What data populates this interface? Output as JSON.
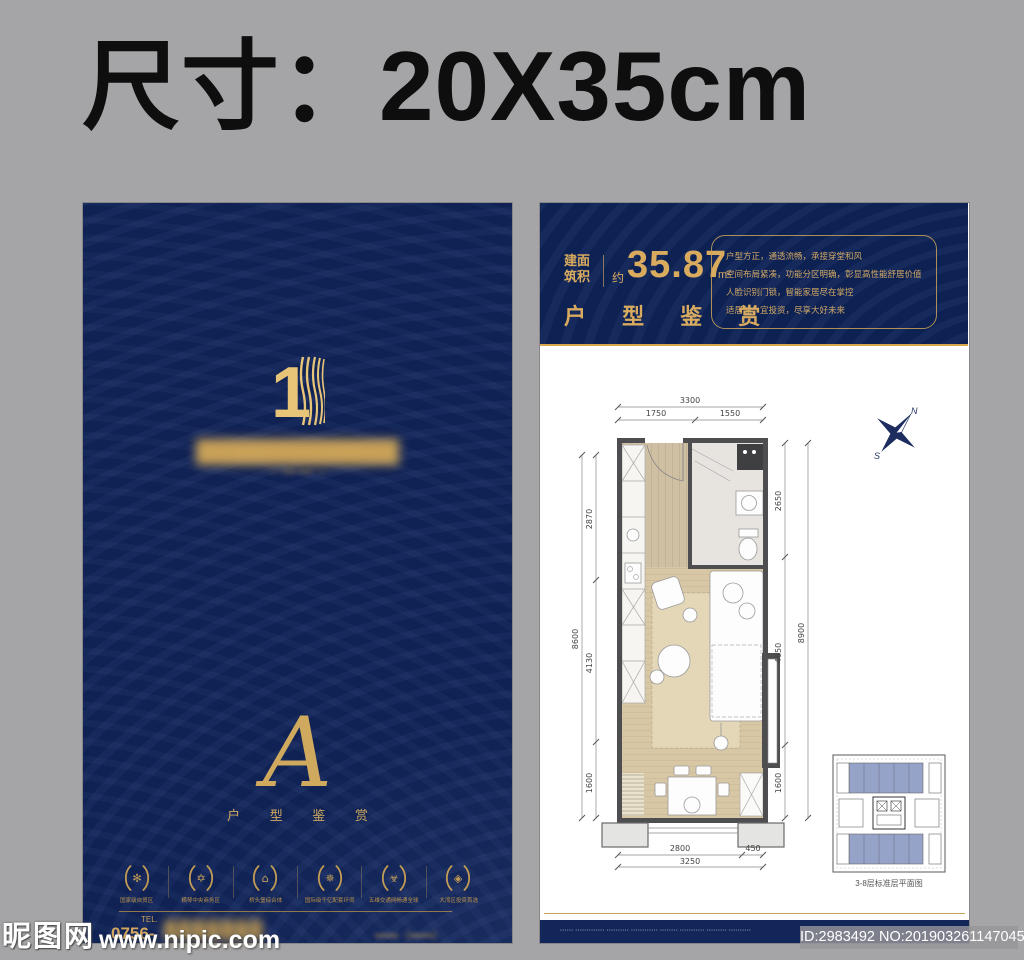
{
  "banner": {
    "size_label": "尺寸：20X35cm"
  },
  "colors": {
    "navy": "#102254",
    "gold": "#d2a75f",
    "keyplan_blue": "#96a3c9",
    "background_gray": "#a5a5a7"
  },
  "left_poster": {
    "logo_number": "1",
    "blurred_title": "█████████████",
    "blurred_subtitle": "— ▪▪▪▪ ▪▪▪▪ —",
    "monogram": "A",
    "monogram_caption": "户 型 鉴 赏",
    "badges": [
      {
        "icon": "✻",
        "label": "国家级自贸区"
      },
      {
        "icon": "✡",
        "label": "横琴中央商务区"
      },
      {
        "icon": "⌂",
        "label": "桥头堡综合体"
      },
      {
        "icon": "✵",
        "label": "国际级千亿配套环伺"
      },
      {
        "icon": "☣",
        "label": "五维交通网畅通全球"
      },
      {
        "icon": "◈",
        "label": "大湾区投资首选"
      }
    ],
    "tel_label": "TEL.",
    "tel_prefix": "0756-",
    "blurred_phone": "▮▮▮▮▮▮▮",
    "blurred_phone_suffix": "▪▪▪▪▪▪（▪▪▪▪▪▪）"
  },
  "right_poster": {
    "header": {
      "area_label_line1": "建面",
      "area_label_line2": "筑积",
      "approx": "约",
      "area_value": "35.87",
      "area_unit": "m²",
      "title": "户 型 鉴 赏",
      "selling_points": [
        "户型方正，通透流畅，承接穿堂和风",
        "空间布局紧凑，功能分区明确，彰显高性能舒居价值",
        "人脸识别门锁，智能家居尽在掌控",
        "适居住、宜投资，尽享大好未来"
      ]
    },
    "floorplan": {
      "dims": {
        "top_total": "3300",
        "top_seg1": "1750",
        "top_seg2": "1550",
        "left_total": "8600",
        "left_seg1": "2870",
        "left_seg2": "4130",
        "left_seg3": "1600",
        "right_total": "8900",
        "right_seg1": "2650",
        "right_seg2": "4650",
        "right_seg3": "1600",
        "bottom_seg1": "2800",
        "bottom_seg2": "450",
        "bottom_total": "3250"
      },
      "compass": {
        "north": "N",
        "south": "S"
      },
      "keyplan_caption": "3-8层标准层平面图"
    },
    "footer_disclaimer": "▪▪▪▪▪▪ ▪▪▪▪▪▪▪▪▪▪▪▪▪ ▪▪▪▪▪▪▪▪▪▪ ▪▪▪▪▪▪▪▪▪▪▪▪ ▪▪▪▪▪▪▪▪ ▪▪▪▪▪▪▪▪▪▪▪ ▪▪▪▪▪▪▪▪▪ ▪▪▪▪▪▪▪▪▪▪"
  },
  "watermarks": {
    "site_name": "昵图网",
    "site_url": "www.nipic.com",
    "id_text": "ID:2983492 NO:20190326114704575086"
  }
}
